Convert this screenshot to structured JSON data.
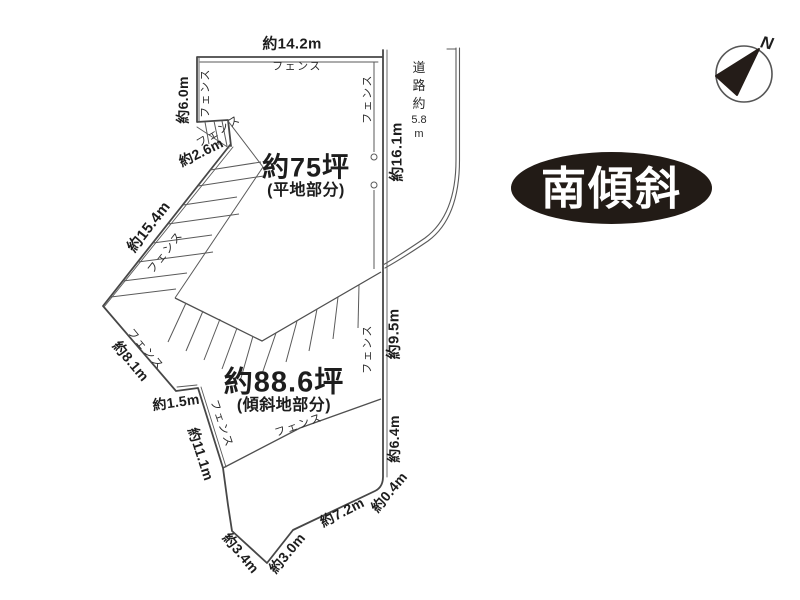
{
  "colors": {
    "background": "#ffffff",
    "line": "#4f4f4f",
    "text": "#1d1d1d",
    "badge_background": "#221b16",
    "badge_text": "#ffffff"
  },
  "labels": {
    "fence": "フェンス"
  },
  "dimensions": {
    "top": "約14.2m",
    "left": "約6.0m",
    "notch": "約2.6m",
    "northwest": "約15.4m",
    "west": "約8.1m",
    "west_step": "約1.5m",
    "southwest": "約11.1m",
    "south_left": "約3.4m",
    "south_mid": "約3.0m",
    "south_right": "約7.2m",
    "southeast_corner": "約0.4m",
    "east_lower": "約6.4m",
    "east_mid": "約9.5m",
    "east_upper": "約16.1m"
  },
  "areas": {
    "flat": {
      "size": "約75坪",
      "type": "(平地部分)"
    },
    "slope": {
      "size": "約88.6坪",
      "type": "(傾斜地部分)"
    }
  },
  "road": {
    "label_parts": [
      "道",
      "路",
      "約",
      "5.8",
      "m"
    ]
  },
  "badge": {
    "text": "南傾斜"
  },
  "compass": {
    "north": "N"
  }
}
